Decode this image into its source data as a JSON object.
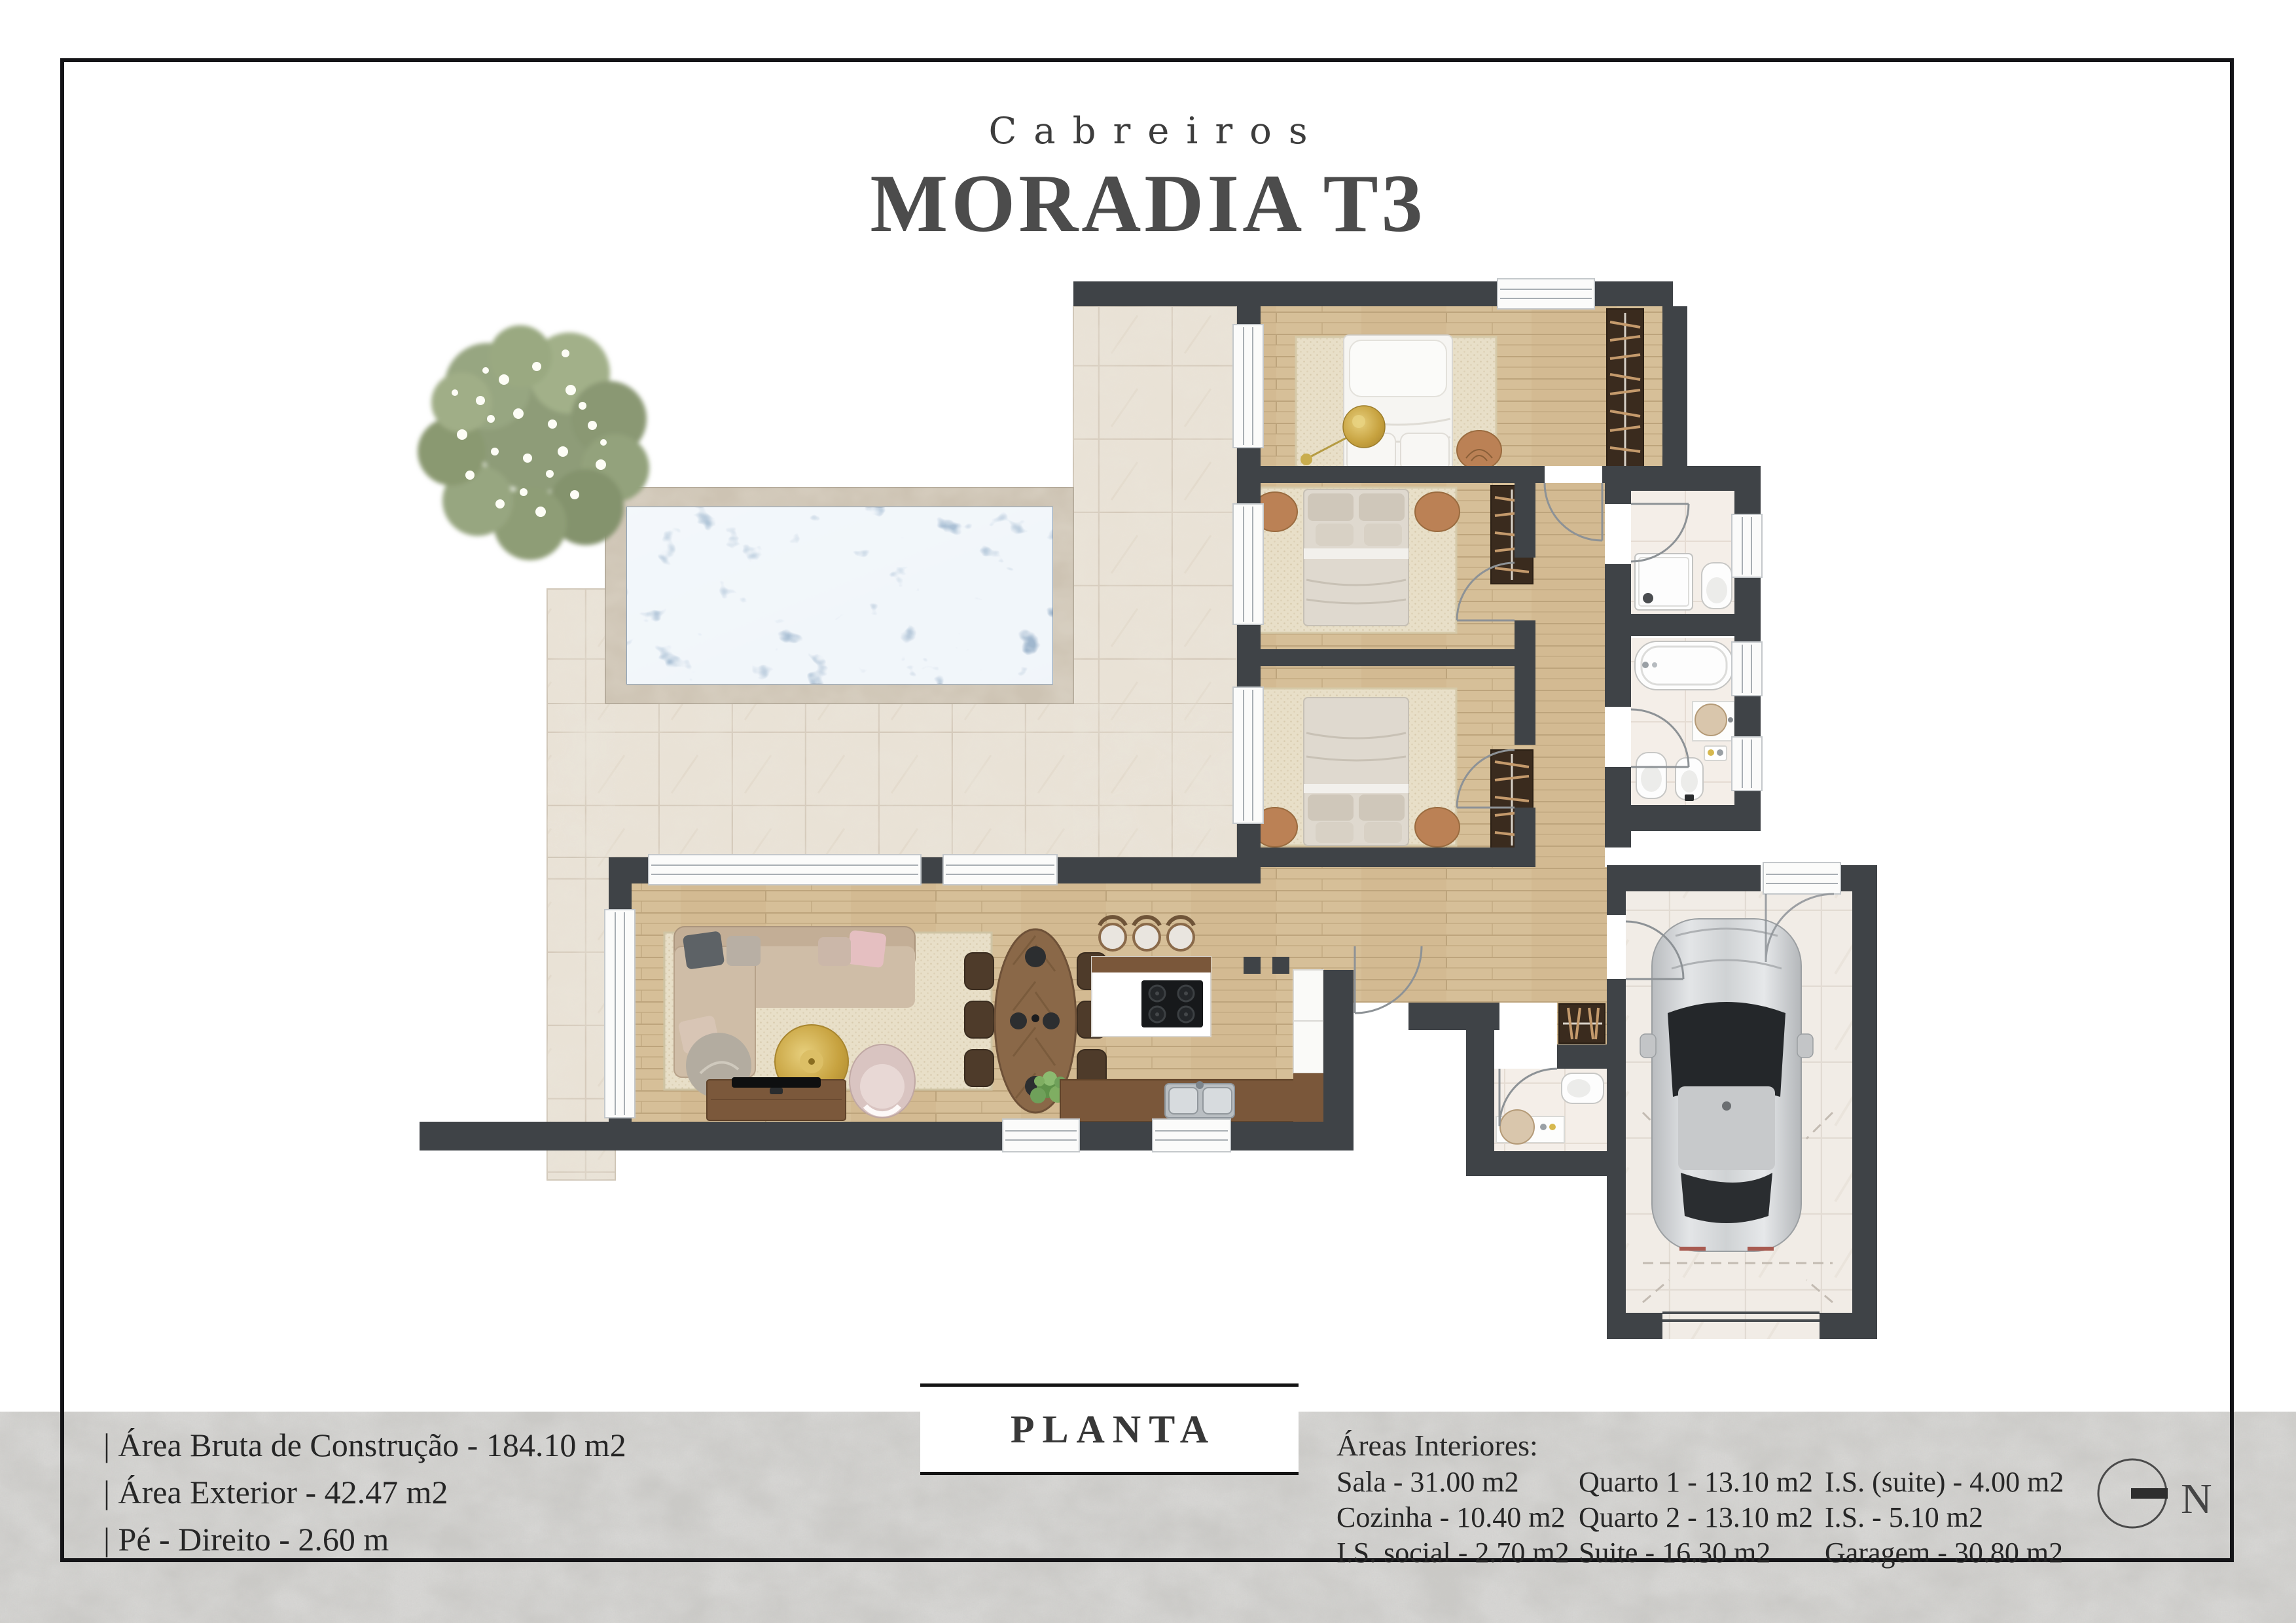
{
  "header": {
    "location": "Cabreiros",
    "title": "MORADIA T3"
  },
  "footer": {
    "planta_label": "PLANTA",
    "specs": [
      "| Área Bruta de Construção - 184.10 m2",
      "| Área Exterior - 42.47 m2",
      "| Pé - Direito - 2.60 m"
    ],
    "areas": {
      "title": "Áreas Interiores:",
      "col1": [
        "Sala - 31.00 m2",
        "Cozinha - 10.40 m2",
        "I.S. social - 2.70 m2"
      ],
      "col2": [
        "Quarto 1 - 13.10 m2",
        "Quarto 2 - 13.10 m2",
        "Suite - 16.30 m2"
      ],
      "col3": [
        "I.S. (suite) - 4.00 m2",
        "I.S. - 5.10 m2",
        "Garagem - 30.80 m2"
      ]
    }
  },
  "compass": {
    "label": "N"
  },
  "colors": {
    "wall": "#3f4347",
    "wood_floor": "#d6bf98",
    "patio_tile": "#e9e2d6",
    "bath_tile": "#f4eee8",
    "pool_water": "#b3c6d8",
    "pool_deck": "#cdc3b3",
    "accent_wood": "#7a573a",
    "page_frame": "#141417",
    "footer_band": "#c9c8c5"
  }
}
